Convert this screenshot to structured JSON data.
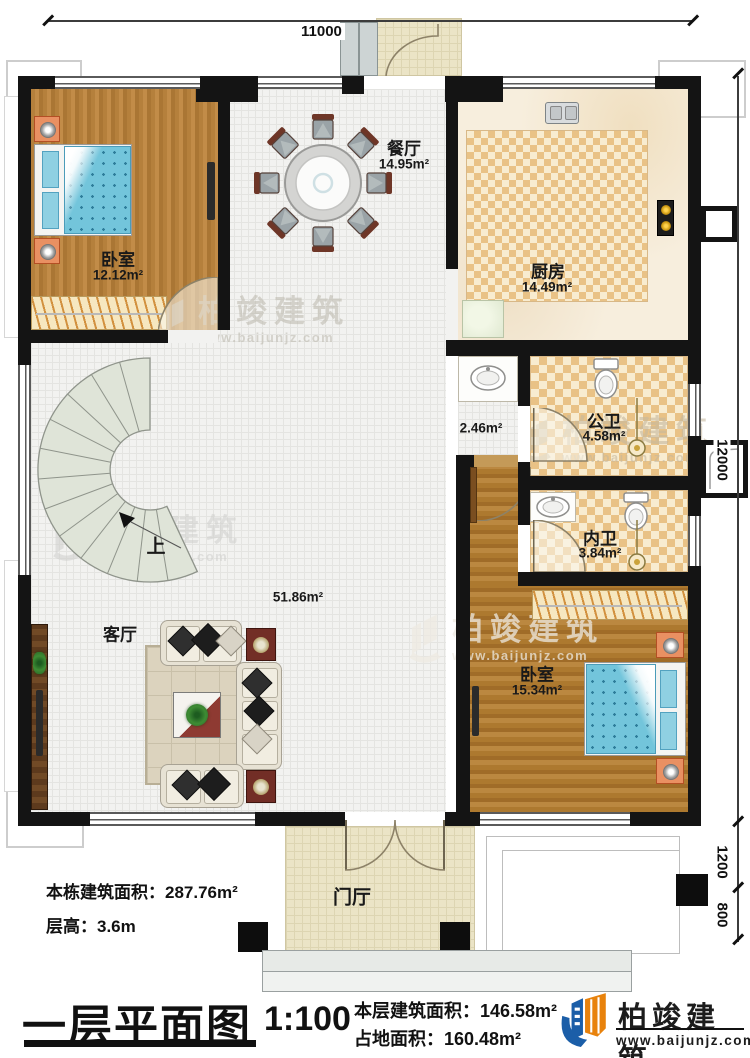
{
  "dims": {
    "top": "11000",
    "right_main": "12000",
    "right_mid": "1200",
    "right_low": "800"
  },
  "rooms": {
    "bedroom_tl": {
      "name": "卧室",
      "area": "12.12m²"
    },
    "dining": {
      "name": "餐厅",
      "area": "14.95m²"
    },
    "kitchen": {
      "name": "厨房",
      "area": "14.49m²"
    },
    "public_bath": {
      "name": "公卫",
      "area": "4.58m²"
    },
    "inner_bath": {
      "name": "内卫",
      "area": "3.84m²"
    },
    "bedroom_br": {
      "name": "卧室",
      "area": "15.34m²"
    },
    "living": {
      "name": "客厅",
      "area": "51.86m²"
    },
    "corridor": {
      "area": "2.46m²"
    },
    "foyer": {
      "name": "门厅"
    },
    "stairs": {
      "direction": "上"
    }
  },
  "annotations": {
    "building_area": "本栋建筑面积：287.76m²",
    "floor_height": "层高：3.6m"
  },
  "footer": {
    "title": "一层平面图",
    "scale": "1:100",
    "floor_area": "本层建筑面积：146.58m²",
    "ground_area": "占地面积：160.48m²",
    "brand": "柏竣建筑",
    "site": "www.baijunjz.com"
  },
  "watermark": {
    "brand": "柏竣建筑",
    "site": "www.baijunjz.com"
  }
}
